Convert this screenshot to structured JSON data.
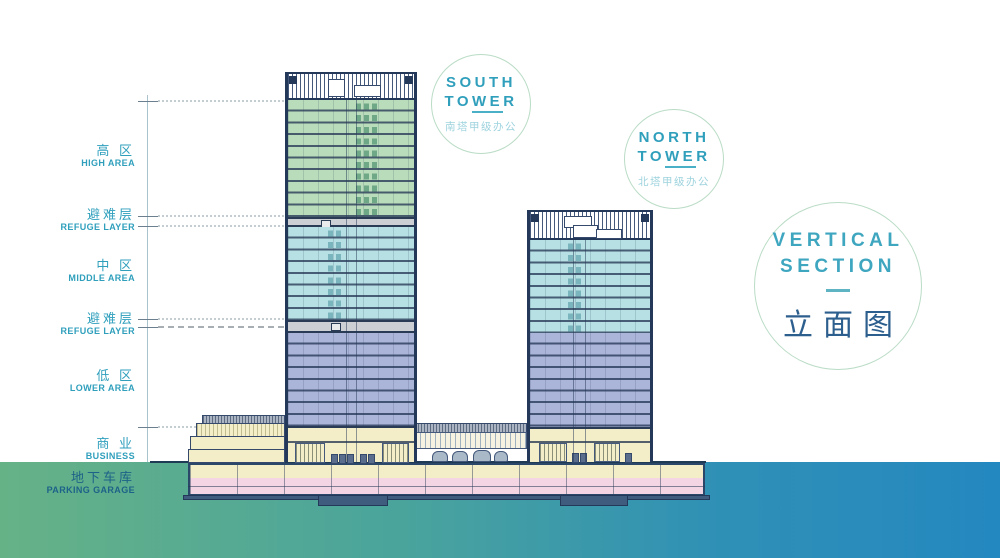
{
  "diagram_title": {
    "line1": "VERTICAL",
    "line2": "SECTION",
    "subtitle_zh": "立面图"
  },
  "badges": {
    "south": {
      "line1": "SOUTH",
      "line2_pre": "TO",
      "line2_ul": "WE",
      "line2_post": "R",
      "subtitle_zh": "南塔甲级办公"
    },
    "north": {
      "line1": "NORTH",
      "line2_pre": "TO",
      "line2_ul": "WE",
      "line2_post": "R",
      "subtitle_zh": "北塔甲级办公"
    }
  },
  "left_labels": [
    {
      "zh": "高 区",
      "en": "HIGH AREA"
    },
    {
      "zh": "避难层",
      "en": "REFUGE LAYER"
    },
    {
      "zh": "中 区",
      "en": "MIDDLE AREA"
    },
    {
      "zh": "避难层",
      "en": "REFUGE LAYER"
    },
    {
      "zh": "低 区",
      "en": "LOWER AREA"
    },
    {
      "zh": "商 业",
      "en": "BUSINESS"
    },
    {
      "zh": "地下车库",
      "en": "PARKING GARAGE"
    }
  ],
  "zone_colors": {
    "high_area": "#b9dcba",
    "middle_area": "#b6e0e3",
    "lower_area": "#abb4d9",
    "refuge_layer": "#ccd0d5",
    "business": "#f3edc8",
    "parking": "#f3d5e3",
    "accent_teal": "#2f9fbc",
    "title_navy": "#2c5f8e",
    "ground_gradient_left": "#66b287",
    "ground_gradient_right": "#2488c0"
  }
}
